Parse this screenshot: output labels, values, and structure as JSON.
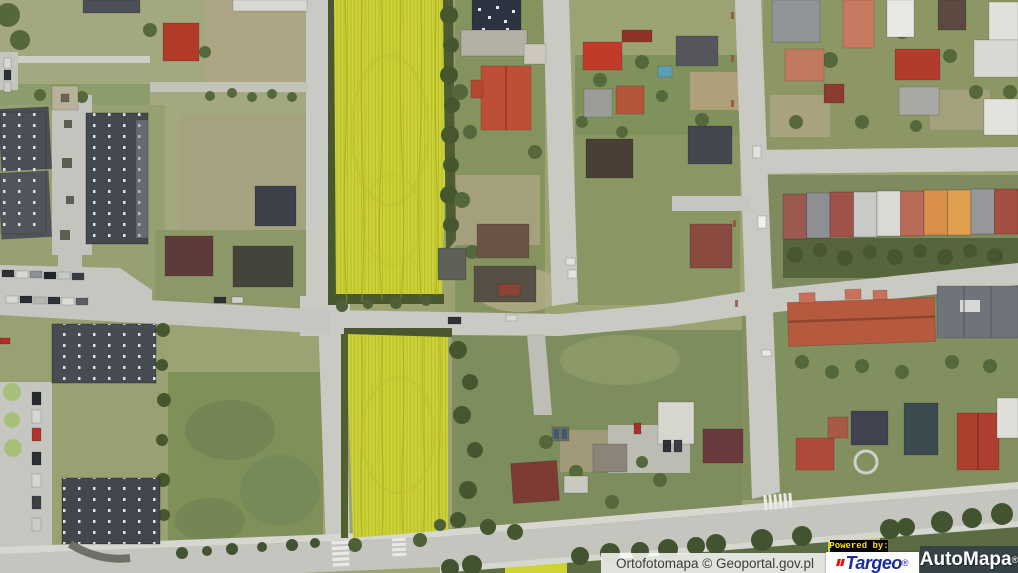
{
  "app": {
    "name": "Targeo AutoMapa orthophoto map view"
  },
  "map": {
    "view_type": "orthophoto aerial imagery",
    "landmarks": [
      "rapeseed-field-north",
      "rapeseed-field-south",
      "residential-houses",
      "row-houses",
      "apartment-blocks",
      "parking-lots",
      "road-network"
    ]
  },
  "attribution": {
    "source": "Ortofotomapa © Geoportal.gov.pl",
    "powered_by": "Powered by:",
    "brands": [
      {
        "name": "Targeo",
        "reg": "®"
      },
      {
        "name": "AutoMapa",
        "reg": "®"
      }
    ]
  },
  "palette": {
    "rapeseed_yellow": "#ccd135",
    "field_streak": "#b4ba2e",
    "hedge_green": "#4a5830",
    "road_gray": "#c9cac3",
    "sidewalk_gray": "#d7d7d1",
    "terrain_green": "#9ba373",
    "roof_red": "#b23a28",
    "roof_salmon": "#c87a61",
    "roof_slate": "#44484f",
    "roof_terracotta": "#b5593f",
    "targeo_blue": "#1b2d9b",
    "targeo_mark_red": "#e01212",
    "powered_by_yellow": "#ffe300",
    "automapa_overlay": "rgba(24,32,74,0.55)",
    "label_background": "rgba(255,255,255,0.82)"
  }
}
